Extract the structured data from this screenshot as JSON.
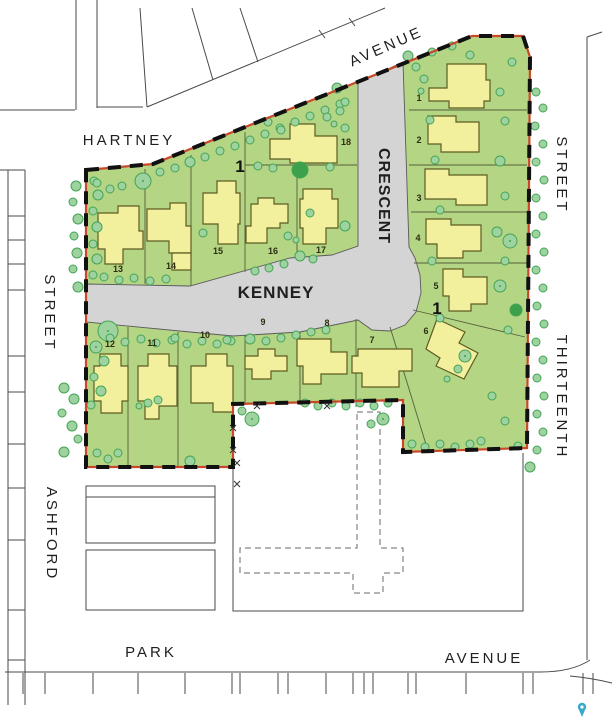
{
  "map": {
    "description": "Subdivision site plan",
    "colors": {
      "lot_green": "#b4d584",
      "road_gray": "#d4d4d4",
      "road_edge": "#5a5a5a",
      "house_yellow": "#f2ef9d",
      "house_outline": "#5d5c22",
      "tree_fill": "#9ed3a0",
      "tree_stroke": "#44a355",
      "dark_tree": "#3da14b",
      "boundary_red": "#c8492a",
      "boundary_black": "#111111",
      "lot_line": "#55603a",
      "context_line": "#4a4a4a",
      "label_color": "#1f1f1f",
      "pin_color": "#3aa9c8"
    },
    "street_labels": [
      {
        "name": "hartney-label",
        "text": "HARTNEY",
        "x": 129,
        "y": 145,
        "rotate": 0,
        "size": 15,
        "spacing": 3,
        "weight": "normal"
      },
      {
        "name": "avenue-top-label",
        "text": "AVENUE",
        "x": 388,
        "y": 51,
        "rotate": -23.5,
        "size": 15,
        "spacing": 3,
        "weight": "normal"
      },
      {
        "name": "crescent-label",
        "text": "CRESCENT",
        "x": 379,
        "y": 196,
        "rotate": 90,
        "size": 16,
        "spacing": 1,
        "weight": "bold"
      },
      {
        "name": "kenney-label",
        "text": "KENNEY",
        "x": 276,
        "y": 298,
        "rotate": 0,
        "size": 17,
        "spacing": 1,
        "weight": "bold"
      },
      {
        "name": "street-right-label",
        "text": "STREET",
        "x": 557,
        "y": 175,
        "rotate": 90,
        "size": 15,
        "spacing": 3,
        "weight": "normal"
      },
      {
        "name": "thirteenth-label",
        "text": "THIRTEENTH",
        "x": 557,
        "y": 397,
        "rotate": 90,
        "size": 15,
        "spacing": 3,
        "weight": "normal"
      },
      {
        "name": "street-left-label",
        "text": "STREET",
        "x": 45,
        "y": 313,
        "rotate": 90,
        "size": 15,
        "spacing": 3,
        "weight": "normal"
      },
      {
        "name": "ashford-label",
        "text": "ASHFORD",
        "x": 47,
        "y": 534,
        "rotate": 90,
        "size": 15,
        "spacing": 3,
        "weight": "normal"
      },
      {
        "name": "park-label",
        "text": "PARK",
        "x": 151,
        "y": 657,
        "rotate": 0,
        "size": 15,
        "spacing": 3,
        "weight": "normal"
      },
      {
        "name": "avenue-bottom-label",
        "text": "AVENUE",
        "x": 484,
        "y": 663,
        "rotate": 0,
        "size": 15,
        "spacing": 3,
        "weight": "normal"
      }
    ],
    "boundary": {
      "path": "M86,170 L153,164 L472,36 L523,36 L530,57 L527,448 L403,452 L403,400 L233,404 L233,467 L86,467 Z"
    },
    "road": {
      "path": "M86,284 L190,286 L290,258 L332,255 L358,246 L358,83 L403,62 L409,247 L415,258 L420,275 L421,293 L416,312 L405,325 L390,331 L372,330 L358,320 L300,332 L233,336 L190,332 L86,322 Z"
    },
    "lot_lines": [
      [
        145,
        169,
        145,
        284
      ],
      [
        191,
        155,
        191,
        286
      ],
      [
        245,
        132,
        245,
        272
      ],
      [
        297,
        165,
        297,
        259
      ],
      [
        245,
        165,
        357,
        165
      ],
      [
        409,
        110,
        527,
        110
      ],
      [
        409,
        165,
        527,
        165
      ],
      [
        411,
        212,
        527,
        212
      ],
      [
        414,
        263,
        527,
        263
      ],
      [
        413,
        310,
        525,
        337
      ],
      [
        390,
        327,
        428,
        451
      ],
      [
        356,
        319,
        356,
        407
      ],
      [
        300,
        332,
        300,
        405
      ],
      [
        245,
        335,
        245,
        405
      ],
      [
        178,
        332,
        178,
        467
      ],
      [
        128,
        327,
        128,
        467
      ]
    ],
    "lot_numbers": [
      {
        "n": "1",
        "x": 419,
        "y": 101
      },
      {
        "n": "2",
        "x": 419,
        "y": 143
      },
      {
        "n": "3",
        "x": 419,
        "y": 201
      },
      {
        "n": "4",
        "x": 418,
        "y": 241
      },
      {
        "n": "5",
        "x": 436,
        "y": 289
      },
      {
        "n": "6",
        "x": 426,
        "y": 334
      },
      {
        "n": "7",
        "x": 372,
        "y": 343
      },
      {
        "n": "8",
        "x": 327,
        "y": 326
      },
      {
        "n": "9",
        "x": 263,
        "y": 325
      },
      {
        "n": "10",
        "x": 205,
        "y": 338
      },
      {
        "n": "11",
        "x": 152,
        "y": 346
      },
      {
        "n": "12",
        "x": 110,
        "y": 347
      },
      {
        "n": "13",
        "x": 118,
        "y": 272
      },
      {
        "n": "14",
        "x": 171,
        "y": 269
      },
      {
        "n": "15",
        "x": 218,
        "y": 254
      },
      {
        "n": "16",
        "x": 273,
        "y": 254
      },
      {
        "n": "17",
        "x": 321,
        "y": 253
      },
      {
        "n": "18",
        "x": 346,
        "y": 145
      }
    ],
    "block_markers": [
      {
        "text": "1",
        "x": 240,
        "y": 172
      },
      {
        "text": "1",
        "x": 437,
        "y": 314
      }
    ],
    "houses": [
      {
        "lot": "1",
        "points": "447,64 486,64 486,80 490,80 490,101 484,101 484,108 449,108 449,101 429,101 429,88 447,88"
      },
      {
        "lot": "2",
        "points": "428,116 456,116 456,122 479,122 479,152 441,152 441,144 428,144"
      },
      {
        "lot": "3",
        "points": "425,169 449,169 449,175 487,175 487,205 456,205 456,199 425,199"
      },
      {
        "lot": "4",
        "points": "426,219 451,219 451,225 481,225 481,251 463,251 463,258 437,258 437,244 426,244"
      },
      {
        "lot": "5",
        "points": "443,269 463,269 463,277 487,277 487,304 471,304 471,311 449,311 449,296 443,296"
      },
      {
        "lot": "6",
        "points": "437,319 465,332 459,343 478,353 464,379 436,366 440,358 426,349"
      },
      {
        "lot": "7",
        "points": "358,349 412,349 412,371 399,371 399,387 362,387 362,373 352,373 352,356 358,356"
      },
      {
        "lot": "8",
        "points": "297,339 331,339 331,352 347,352 347,374 321,374 321,384 303,384 303,366 297,366"
      },
      {
        "lot": "9",
        "points": "245,356 258,356 258,349 275,349 275,356 287,356 287,371 271,371 271,379 252,379 252,369 245,369"
      },
      {
        "lot": "10",
        "points": "206,354 227,354 227,366 233,366 233,412 213,412 213,403 191,403 191,366 206,366"
      },
      {
        "lot": "11",
        "points": "148,354 169,354 169,366 177,366 177,406 159,406 159,419 145,419 145,401 138,401 138,366 148,366"
      },
      {
        "lot": "12",
        "points": "100,354 121,354 121,366 128,366 128,401 122,401 122,413 101,413 101,401 94,401 94,366 100,366"
      },
      {
        "lot": "13",
        "points": "98,213 118,213 118,206 139,206 139,231 143,231 143,249 123,249 123,264 105,264 105,249 98,249"
      },
      {
        "lot": "14",
        "points": "147,209 170,209 170,203 186,203 186,226 191,226 191,253 169,253 169,241 147,241"
      },
      {
        "lot": "14-garage",
        "points": "172,253 191,253 191,270 172,270"
      },
      {
        "lot": "15",
        "points": "217,181 236,181 236,193 240,193 240,224 238,224 238,244 218,244 218,224 203,224 203,193 217,193"
      },
      {
        "lot": "16",
        "points": "258,198 274,198 274,204 288,204 288,223 280,223 280,228 267,228 267,243 246,243 246,226 251,226 251,204 258,204"
      },
      {
        "lot": "17",
        "points": "303,189 332,189 332,199 338,199 338,228 326,228 326,244 303,244 303,228 300,228 300,199 303,199"
      },
      {
        "lot": "18",
        "points": "290,124 315,124 315,136 337,136 337,163 290,163 290,159 270,159 270,139 290,139"
      }
    ],
    "trees": [
      [
        76,
        186,
        5
      ],
      [
        73,
        202,
        4
      ],
      [
        78,
        219,
        5
      ],
      [
        74,
        236,
        4
      ],
      [
        77,
        253,
        5
      ],
      [
        73,
        269,
        4
      ],
      [
        78,
        287,
        5
      ],
      [
        64,
        388,
        5
      ],
      [
        74,
        399,
        5
      ],
      [
        62,
        413,
        4
      ],
      [
        72,
        426,
        5
      ],
      [
        78,
        439,
        4
      ],
      [
        64,
        452,
        5
      ],
      [
        94,
        181,
        4
      ],
      [
        98,
        195,
        5
      ],
      [
        93,
        211,
        4
      ],
      [
        97,
        227,
        5
      ],
      [
        93,
        244,
        4
      ],
      [
        97,
        259,
        5
      ],
      [
        93,
        275,
        4
      ],
      [
        108,
        331,
        10
      ],
      [
        96,
        347,
        6
      ],
      [
        104,
        361,
        5
      ],
      [
        94,
        377,
        4
      ],
      [
        101,
        391,
        5
      ],
      [
        91,
        405,
        4
      ],
      [
        97,
        453,
        4
      ],
      [
        108,
        459,
        4
      ],
      [
        118,
        453,
        4
      ],
      [
        190,
        461,
        5
      ],
      [
        97,
        183,
        4
      ],
      [
        110,
        189,
        4
      ],
      [
        122,
        186,
        4
      ],
      [
        143,
        181,
        8
      ],
      [
        160,
        172,
        4
      ],
      [
        175,
        168,
        4
      ],
      [
        190,
        162,
        5
      ],
      [
        205,
        157,
        4
      ],
      [
        220,
        151,
        4
      ],
      [
        235,
        146,
        4
      ],
      [
        250,
        140,
        4
      ],
      [
        265,
        134,
        4
      ],
      [
        280,
        128,
        4
      ],
      [
        295,
        122,
        4
      ],
      [
        310,
        116,
        4
      ],
      [
        325,
        110,
        4
      ],
      [
        340,
        104,
        4
      ],
      [
        268,
        122,
        4
      ],
      [
        281,
        130,
        4
      ],
      [
        258,
        166,
        4
      ],
      [
        273,
        168,
        4
      ],
      [
        330,
        167,
        4
      ],
      [
        345,
        128,
        4
      ],
      [
        337,
        88,
        5
      ],
      [
        345,
        102,
        4
      ],
      [
        340,
        111,
        4
      ],
      [
        327,
        117,
        4
      ],
      [
        334,
        124,
        3
      ],
      [
        408,
        56,
        5
      ],
      [
        416,
        67,
        4
      ],
      [
        424,
        79,
        4
      ],
      [
        421,
        91,
        3
      ],
      [
        432,
        52,
        4
      ],
      [
        452,
        46,
        4
      ],
      [
        470,
        55,
        4
      ],
      [
        512,
        62,
        4
      ],
      [
        203,
        233,
        4
      ],
      [
        310,
        213,
        4
      ],
      [
        345,
        226,
        5
      ],
      [
        300,
        256,
        5
      ],
      [
        288,
        236,
        4
      ],
      [
        296,
        240,
        3
      ],
      [
        104,
        277,
        4
      ],
      [
        119,
        280,
        4
      ],
      [
        134,
        278,
        4
      ],
      [
        150,
        281,
        4
      ],
      [
        166,
        279,
        4
      ],
      [
        255,
        271,
        4
      ],
      [
        269,
        268,
        4
      ],
      [
        284,
        264,
        4
      ],
      [
        313,
        259,
        4
      ],
      [
        110,
        338,
        4
      ],
      [
        125,
        342,
        4
      ],
      [
        141,
        339,
        4
      ],
      [
        156,
        343,
        4
      ],
      [
        172,
        340,
        4
      ],
      [
        187,
        344,
        4
      ],
      [
        202,
        341,
        4
      ],
      [
        217,
        344,
        4
      ],
      [
        231,
        341,
        4
      ],
      [
        250,
        339,
        5
      ],
      [
        266,
        341,
        4
      ],
      [
        281,
        338,
        4
      ],
      [
        296,
        335,
        4
      ],
      [
        311,
        332,
        4
      ],
      [
        326,
        330,
        4
      ],
      [
        148,
        403,
        4
      ],
      [
        158,
        400,
        4
      ],
      [
        139,
        406,
        3
      ],
      [
        252,
        419,
        7
      ],
      [
        242,
        411,
        4
      ],
      [
        175,
        338,
        4
      ],
      [
        227,
        340,
        4
      ],
      [
        305,
        403,
        4
      ],
      [
        318,
        406,
        4
      ],
      [
        332,
        403,
        4
      ],
      [
        346,
        406,
        4
      ],
      [
        360,
        403,
        4
      ],
      [
        374,
        406,
        4
      ],
      [
        388,
        403,
        4
      ],
      [
        383,
        419,
        6
      ],
      [
        371,
        424,
        4
      ],
      [
        412,
        444,
        4
      ],
      [
        425,
        447,
        4
      ],
      [
        440,
        444,
        4
      ],
      [
        455,
        447,
        4
      ],
      [
        470,
        444,
        4
      ],
      [
        465,
        356,
        6
      ],
      [
        458,
        369,
        4
      ],
      [
        447,
        379,
        3
      ],
      [
        492,
        396,
        4
      ],
      [
        505,
        421,
        4
      ],
      [
        518,
        446,
        4
      ],
      [
        481,
        441,
        4
      ],
      [
        430,
        120,
        4
      ],
      [
        500,
        92,
        4
      ],
      [
        505,
        121,
        4
      ],
      [
        435,
        160,
        4
      ],
      [
        500,
        161,
        5
      ],
      [
        440,
        210,
        4
      ],
      [
        505,
        196,
        4
      ],
      [
        510,
        241,
        7
      ],
      [
        497,
        232,
        5
      ],
      [
        432,
        261,
        4
      ],
      [
        505,
        261,
        4
      ],
      [
        500,
        286,
        6
      ],
      [
        440,
        318,
        4
      ],
      [
        508,
        330,
        4
      ],
      [
        536,
        92,
        4
      ],
      [
        543,
        108,
        4
      ],
      [
        535,
        126,
        4
      ],
      [
        543,
        144,
        4
      ],
      [
        536,
        162,
        4
      ],
      [
        544,
        180,
        4
      ],
      [
        536,
        198,
        4
      ],
      [
        543,
        216,
        4
      ],
      [
        536,
        234,
        4
      ],
      [
        544,
        252,
        4
      ],
      [
        536,
        270,
        4
      ],
      [
        543,
        288,
        4
      ],
      [
        537,
        306,
        4
      ],
      [
        544,
        324,
        4
      ],
      [
        536,
        342,
        4
      ],
      [
        543,
        360,
        4
      ],
      [
        537,
        378,
        4
      ],
      [
        544,
        396,
        4
      ],
      [
        537,
        414,
        4
      ],
      [
        543,
        432,
        4
      ],
      [
        537,
        450,
        4
      ],
      [
        530,
        467,
        5
      ]
    ],
    "dark_trees": [
      [
        300,
        170,
        8
      ],
      [
        516,
        310,
        6
      ]
    ],
    "context": {
      "lines": [
        [
          0,
          110,
          75,
          110
        ],
        [
          76,
          0,
          76,
          110
        ],
        [
          97,
          0,
          97,
          108
        ],
        [
          97,
          107,
          143,
          107
        ],
        [
          140,
          8,
          147,
          107
        ],
        [
          192,
          8,
          213,
          80
        ],
        [
          240,
          8,
          258,
          62
        ],
        [
          147,
          107,
          385,
          8
        ],
        [
          319,
          30,
          325,
          38
        ],
        [
          349,
          18,
          355,
          26
        ],
        [
          0,
          170,
          25,
          170
        ],
        [
          25,
          170,
          25,
          705
        ],
        [
          8,
          170,
          8,
          705
        ],
        [
          587,
          37,
          587,
          660
        ],
        [
          587,
          37,
          602,
          32
        ],
        [
          5,
          672,
          540,
          672
        ]
      ],
      "curves": [
        "M540,672 C560,672 578,668 590,660",
        "M570,676 Q592,678 612,683"
      ],
      "park_tick_xs": [
        23,
        45,
        93,
        138,
        185,
        232,
        240,
        278,
        288,
        326,
        353,
        364,
        373,
        408,
        416,
        466,
        523,
        533,
        583,
        593
      ],
      "park_tick_y1": 672,
      "park_tick_y2": 694,
      "left_tick_ys": [
        216,
        240,
        264,
        290,
        356,
        392,
        444,
        488,
        540,
        610,
        660
      ],
      "left_tick_x1": 8,
      "left_tick_x2": 25,
      "neighbor_buildings": [
        [
          86,
          486,
          129,
          11
        ],
        [
          86,
          497,
          129,
          46
        ],
        [
          86,
          550,
          129,
          60
        ]
      ],
      "school_parcel_path": "M233,405 L233,611 L523,611 L523,453",
      "existing_building_path": "M357,412 L380,412 L380,548 L403,548 L403,573 L383,573 L383,593 L353,593 L353,573 L240,573 L240,548 L357,548 Z",
      "fence_marks": [
        [
          233,
          428
        ],
        [
          233,
          450
        ],
        [
          237,
          463
        ],
        [
          237,
          484
        ],
        [
          257,
          406
        ],
        [
          327,
          406
        ]
      ]
    },
    "pin": {
      "x": 582,
      "y": 711
    }
  }
}
